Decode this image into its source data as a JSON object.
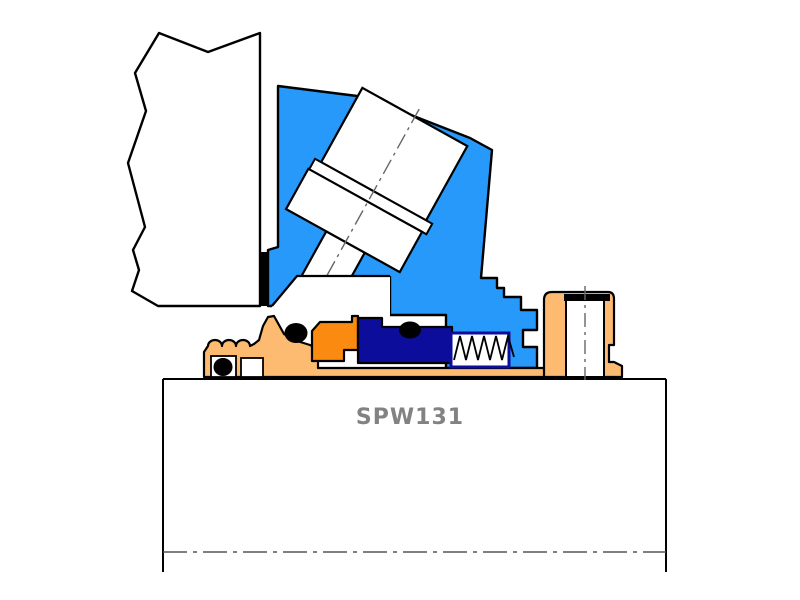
{
  "diagram": {
    "label": "SPW131",
    "label_color": "#828282",
    "type": "mechanical-seal-cross-section"
  },
  "colors": {
    "gland_blue": "#2699fb",
    "seal_navy": "#0d0d9b",
    "rotary_orange": "#fb8a10",
    "sleeve_tan": "#fcbb70",
    "outline_black": "#000000",
    "oring_black": "#000000",
    "centerline_gray": "#666666",
    "background_white": "#ffffff"
  },
  "parts": {
    "housing": "pump housing (break-line section)",
    "gasket": "gland gasket (black strip)",
    "gland": "seal gland plate (blue)",
    "gland_bolt": "angled gland bolt with washer and flange",
    "rotary_holder": "rotary unit holder (orange)",
    "seal_face": "seal face (navy)",
    "spring": "coil spring",
    "sleeve": "shaft sleeve (tan)",
    "drive_collar": "set-screw drive collar (tan)",
    "orings": "elastomer O-rings (black)",
    "shaft": "pump shaft with centerline"
  }
}
